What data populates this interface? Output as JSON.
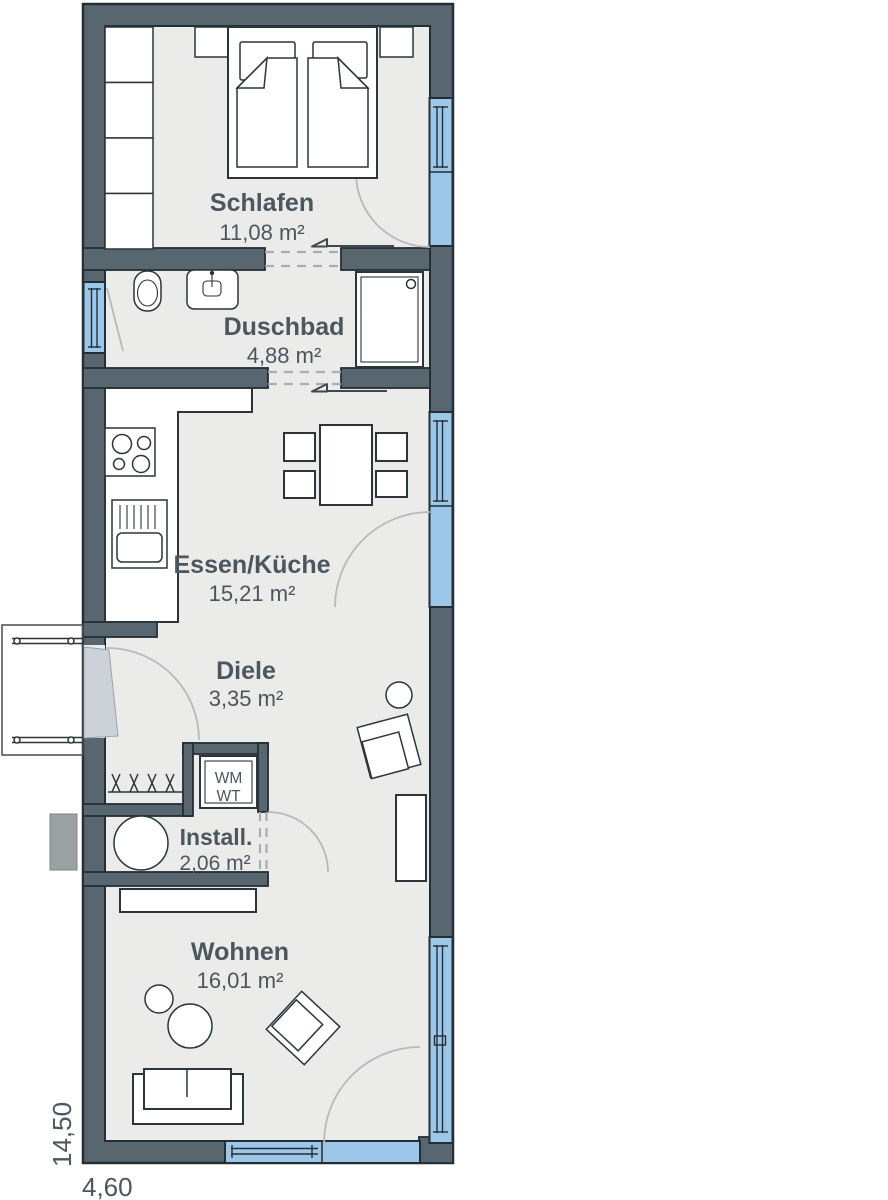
{
  "plan": {
    "rooms": [
      {
        "name": "Schlafen",
        "area": "11,08 m²"
      },
      {
        "name": "Duschbad",
        "area": "4,88 m²"
      },
      {
        "name": "Essen/Küche",
        "area": "15,21 m²"
      },
      {
        "name": "Diele",
        "area": "3,35 m²"
      },
      {
        "name": "Install.",
        "area": "2,06 m²"
      },
      {
        "name": "Wohnen",
        "area": "16,01 m²"
      }
    ],
    "appliance_labels": {
      "wm": "WM",
      "wt": "WT"
    },
    "dimensions": {
      "width": "4,60",
      "height": "14,50"
    }
  },
  "colors": {
    "wall": "#57666f",
    "wall_outline": "#242e35",
    "floor": "#ebebea",
    "window_blue": "#9cc7e8",
    "furniture_outline": "#2b353b",
    "furniture_fill": "#ffffff",
    "label": "#4b565e",
    "dash": "#a8aeb2",
    "arc": "#b6babd",
    "leaf": "#ccd3d8",
    "exterior_gray": "#9ba0a3",
    "page_bg": "#ffffff"
  }
}
